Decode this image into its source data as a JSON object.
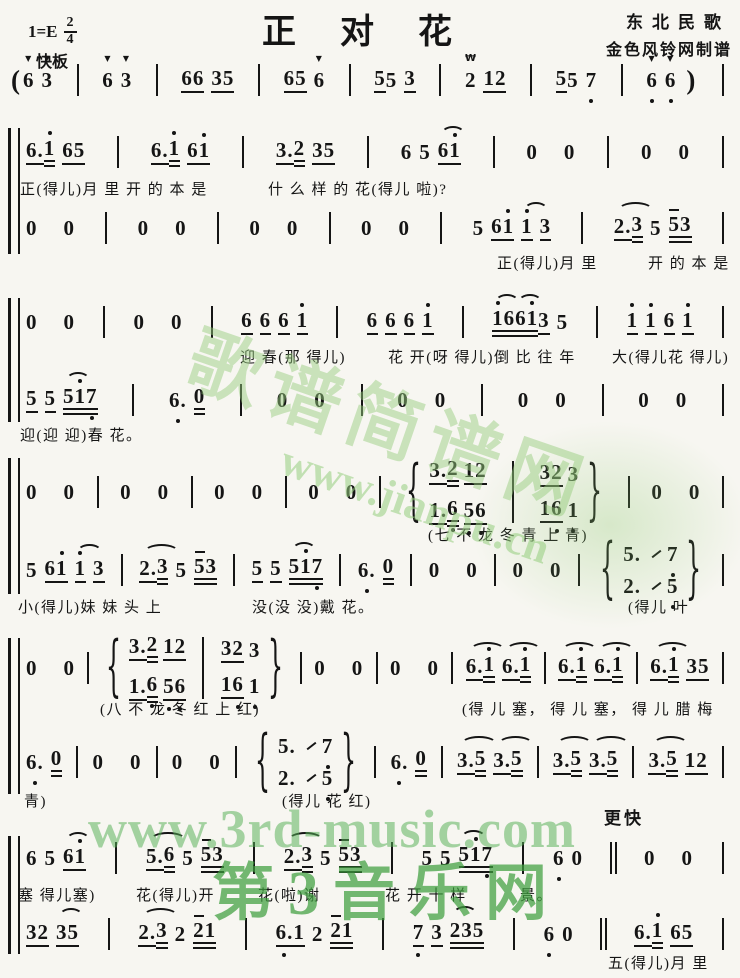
{
  "meta": {
    "title": "正对花",
    "key": "1=E",
    "meter_num": "2",
    "meter_den": "4",
    "tempo": "快板",
    "tempo2": "更快",
    "credit_source": "东北民歌",
    "credit_maker": "金色风铃网制谱"
  },
  "watermarks": {
    "site_big": "歌谱简谱网",
    "site_url": "www.jianpu.cn",
    "music3_url": "www.3rd-music.com",
    "music3_name": "第3音乐网"
  },
  "colors": {
    "ink": "#151515",
    "paper": "#f7f6f1",
    "wm_green": "#55aa55"
  },
  "score": {
    "brackets": [
      {
        "y": 128,
        "h": 126
      },
      {
        "y": 298,
        "h": 124
      },
      {
        "y": 458,
        "h": 136
      },
      {
        "y": 638,
        "h": 156
      },
      {
        "y": 836,
        "h": 118
      }
    ],
    "lines": [
      {
        "type": "notes",
        "y": 62,
        "x": 8,
        "tokens": [
          "(",
          "6v",
          "3v",
          "|",
          "6v",
          "3v",
          "|",
          "66_",
          "35_",
          "|",
          "65_",
          "6v",
          "|",
          "5_j",
          "5",
          "3_",
          "|",
          "2T",
          "12_",
          "|",
          "5_j",
          "5",
          "7,",
          "|",
          "6,v",
          "6,v",
          ")",
          "|"
        ]
      },
      {
        "type": "notes",
        "y": 134,
        "x": 26,
        "tokens": [
          "6._j",
          "1'=",
          "6_j",
          "5_",
          "|",
          "6._j",
          "1'=",
          "6_j",
          "1'_",
          "|",
          "3._j",
          "2=",
          "3_j",
          "5_",
          "|",
          "6",
          "5",
          "6_jr",
          "1'_",
          "|",
          "0",
          "0",
          "|",
          "0",
          "0",
          "|"
        ]
      },
      {
        "type": "lyrics",
        "y": 178,
        "segs": [
          {
            "x": 20,
            "t": "正(得儿)月 里  开 的 本 是"
          },
          {
            "x": 268,
            "t": "什 么 样 的  花(得儿 啦)?"
          }
        ]
      },
      {
        "type": "notes",
        "y": 210,
        "x": 26,
        "tokens": [
          "0",
          "0",
          "|",
          "0",
          "0",
          "|",
          "0",
          "0",
          "|",
          "0",
          "0",
          "|",
          "5",
          "6_j",
          "1'_",
          "1'_r",
          "3_",
          "|",
          "2._jr",
          "3=",
          "5",
          "5m=j",
          "3=",
          "|"
        ]
      },
      {
        "type": "lyrics",
        "y": 252,
        "segs": [
          {
            "x": 497,
            "t": "正(得儿)月 里"
          },
          {
            "x": 648,
            "t": "开 的 本 是"
          }
        ]
      },
      {
        "type": "notes",
        "y": 304,
        "x": 26,
        "tokens": [
          "0",
          "0",
          "|",
          "0",
          "0",
          "|",
          "6_",
          "6_",
          "6_",
          "1'_",
          "|",
          "6_",
          "6_",
          "6_",
          "1'_",
          "|",
          "1'=jr",
          "6=j",
          "6=jr",
          "1'=j",
          "3_",
          "5",
          "|",
          "1'_",
          "1'_",
          "6_",
          "1'_",
          "|"
        ]
      },
      {
        "type": "lyrics",
        "y": 346,
        "segs": [
          {
            "x": 240,
            "t": "迎 春(那 得儿)"
          },
          {
            "x": 388,
            "t": "花 开(呀 得儿)倒 比 往 年"
          },
          {
            "x": 612,
            "t": "大(得儿花 得儿)"
          }
        ]
      },
      {
        "type": "notes",
        "y": 382,
        "x": 26,
        "tokens": [
          "5_",
          "5_",
          "5=jr",
          "1'=j",
          "7,=",
          "|",
          "6.,",
          "0=",
          "|",
          "0",
          "0",
          "|",
          "0",
          "0",
          "|",
          "0",
          "0",
          "|",
          "0",
          "0",
          "|"
        ]
      },
      {
        "type": "lyrics",
        "y": 424,
        "segs": [
          {
            "x": 20,
            "t": "迎(迎 迎)春  花。"
          }
        ]
      },
      {
        "type": "notes",
        "y": 474,
        "x": 26,
        "tokens": [
          "0",
          "0",
          "|",
          "0",
          "0",
          "|",
          "0",
          "0",
          "|",
          "0",
          "0",
          "|",
          "{",
          {
            "st": [
              [
                "3._j",
                "2=",
                "1_j",
                "2_"
              ],
              [
                "1._j",
                "6,=",
                "5,_j",
                "6,_"
              ]
            ]
          },
          "|t",
          {
            "st": [
              [
                "3_j",
                "2_",
                "3"
              ],
              [
                "1_j",
                "6,_",
                "1,"
              ]
            ]
          },
          "}",
          "|",
          "0",
          "0",
          "|"
        ]
      },
      {
        "type": "lyrics",
        "y": 524,
        "segs": [
          {
            "x": 428,
            "t": "(七 不 龙 冬  青 上 青)"
          }
        ]
      },
      {
        "type": "notes",
        "y": 552,
        "x": 26,
        "tokens": [
          "5",
          "6_j",
          "1'_",
          "1'_r",
          "3_",
          "|",
          "2._jr",
          "3=",
          "5",
          "5m=j",
          "3=",
          "|",
          "5_",
          "5_",
          "5=jr",
          "1'=j",
          "7,=",
          "|",
          "6.,",
          "0=",
          "|",
          "0",
          "0",
          "|",
          "0",
          "0",
          "|",
          "{",
          {
            "st": [
              [
                "5.",
                "/",
                "7,"
              ],
              [
                "2.",
                "/",
                "5,"
              ]
            ]
          },
          "}",
          "|"
        ]
      },
      {
        "type": "lyrics",
        "y": 596,
        "segs": [
          {
            "x": 18,
            "t": "小(得儿)妹 妹  头  上"
          },
          {
            "x": 252,
            "t": "没(没 没)戴  花。"
          },
          {
            "x": 628,
            "t": "(得儿  叶"
          }
        ]
      },
      {
        "type": "notes",
        "y": 650,
        "x": 26,
        "tokens": [
          "0",
          "0",
          "|",
          "{",
          {
            "st": [
              [
                "3._j",
                "2=",
                "1_j",
                "2_"
              ],
              [
                "1._j",
                "6,=",
                "5,_j",
                "6,_"
              ]
            ]
          },
          "|t",
          {
            "st": [
              [
                "3_j",
                "2_",
                "3"
              ],
              [
                "1_j",
                "6,_",
                "1,"
              ]
            ]
          },
          "}",
          "|",
          "0",
          "0",
          "|",
          "0",
          "0",
          "|",
          "6._jr",
          "1'=",
          "6._jr",
          "1'=",
          "|",
          "6._jr",
          "1'=",
          "6._jr",
          "1'=",
          "|",
          "6._jr",
          "1'=",
          "3_j",
          "5_",
          "|"
        ]
      },
      {
        "type": "lyrics",
        "y": 698,
        "segs": [
          {
            "x": 100,
            "t": "(八 不 龙 冬  红 上 红)"
          },
          {
            "x": 462,
            "t": "(得 儿 塞，  得 儿 塞，  得 儿 腊 梅"
          }
        ]
      },
      {
        "type": "notes",
        "y": 744,
        "x": 26,
        "tokens": [
          "6.,",
          "0=",
          "|",
          "0",
          "0",
          "|",
          "0",
          "0",
          "|",
          "{",
          {
            "st": [
              [
                "5.",
                "/",
                "7,"
              ],
              [
                "2.",
                "/",
                "5,"
              ]
            ]
          },
          "}",
          "|",
          "6.,",
          "0=",
          "|",
          "3._jr",
          "5=",
          "3._jr",
          "5=",
          "|",
          "3._jr",
          "5=",
          "3._jr",
          "5=",
          "|",
          "3._jr",
          "5=",
          "1_j",
          "2_",
          "|"
        ]
      },
      {
        "type": "lyrics",
        "y": 790,
        "segs": [
          {
            "x": 24,
            "t": "青)"
          },
          {
            "x": 282,
            "t": "(得儿  花  红)"
          }
        ]
      },
      {
        "type": "notes",
        "y": 840,
        "x": 26,
        "tokens": [
          "6",
          "5",
          "6_jr",
          "1'_",
          "|",
          "5._jr",
          "6=",
          "5",
          "5m=j",
          "3=",
          "|",
          "2._jr",
          "3=",
          "5",
          "5m=j",
          "3=",
          "|",
          "5",
          "5",
          "5=jr",
          "1'=j",
          "7,=",
          "|",
          "6,",
          "0",
          "||",
          "0",
          "0",
          "|"
        ]
      },
      {
        "type": "lyrics",
        "y": 884,
        "segs": [
          {
            "x": 18,
            "t": "塞 得儿塞)"
          },
          {
            "x": 136,
            "t": "花(得儿)开"
          },
          {
            "x": 258,
            "t": "花(啦)谢"
          },
          {
            "x": 385,
            "t": "花 开 十 样"
          },
          {
            "x": 520,
            "t": "景。"
          }
        ]
      },
      {
        "type": "notes",
        "y": 916,
        "x": 26,
        "tokens": [
          "3_j",
          "2_",
          "3_jr",
          "5_",
          "|",
          "2._jr",
          "3=",
          "2",
          "2m=j",
          "1=",
          "|",
          "6.,_j",
          "1_",
          "2",
          "2m=j",
          "1=",
          "|",
          "7,_",
          "3_",
          "2=jr",
          "3=j",
          "5=",
          "|",
          "6,",
          "0",
          "||",
          "6._j",
          "1'=",
          "6_j",
          "5_",
          "|"
        ]
      },
      {
        "type": "lyrics",
        "y": 952,
        "segs": [
          {
            "x": 608,
            "t": "五(得儿)月 里"
          }
        ]
      }
    ]
  }
}
